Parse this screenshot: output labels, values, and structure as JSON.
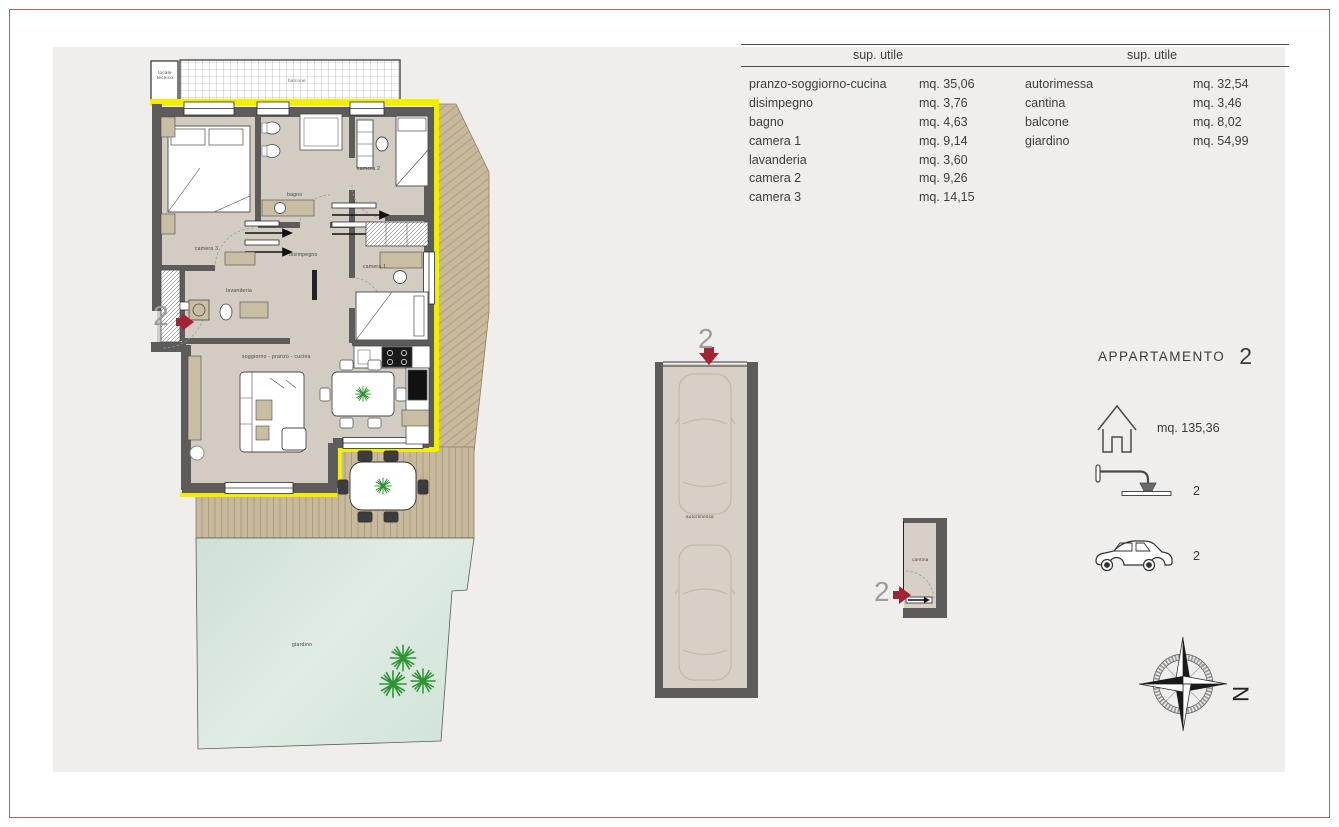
{
  "page": {
    "frame_color": "#b2605c",
    "panel_bg": "#efeeec"
  },
  "surface_table": {
    "header_left": "sup. utile",
    "header_right": "sup. utile",
    "left": [
      {
        "label": "pranzo-soggiorno-cucina",
        "value": "mq. 35,06"
      },
      {
        "label": "disimpegno",
        "value": "mq. 3,76"
      },
      {
        "label": "bagno",
        "value": "mq. 4,63"
      },
      {
        "label": "camera 1",
        "value": "mq. 9,14"
      },
      {
        "label": "lavanderia",
        "value": "mq. 3,60"
      },
      {
        "label": "camera 2",
        "value": "mq. 9,26"
      },
      {
        "label": "camera 3",
        "value": "mq. 14,15"
      }
    ],
    "right": [
      {
        "label": "autorimessa",
        "value": "mq. 32,54"
      },
      {
        "label": "cantina",
        "value": "mq. 3,46"
      },
      {
        "label": "balcone",
        "value": "mq. 8,02"
      },
      {
        "label": "giardino",
        "value": "mq. 54,99"
      }
    ]
  },
  "apartment_panel": {
    "title": "APPARTAMENTO",
    "number": "2",
    "total_area": "mq. 135,36",
    "bathrooms_count": "2",
    "cars_count": "2"
  },
  "plan_labels": {
    "balcone": "balcone",
    "locale_tecnico": "locale tecnico",
    "camera3": "camera 3",
    "bagno": "bagno",
    "camera2": "camera 2",
    "disimpegno": "disimpegno",
    "lavanderia": "lavanderia",
    "camera1": "camera 1",
    "soggiorno": "soggiorno - pranzo - cucina",
    "giardino": "giardino",
    "autorimessa": "autorimessa",
    "cantina": "cantina"
  },
  "markers": {
    "apartment": "2",
    "garage": "2",
    "cantina": "2"
  },
  "compass": {
    "north_label": "N"
  },
  "icons": {
    "house": "house-icon",
    "shower": "shower-icon",
    "car": "car-icon",
    "compass": "compass-rose-icon"
  },
  "colors": {
    "wall_grey": "#5d5c5a",
    "floor_beige": "#d3ccc3",
    "insulation_yellow": "#f2ee00",
    "deck_tan": "#c8b99d",
    "garden_green": "#d8e8de",
    "plant_green": "#2e9433",
    "marker_red": "#a02433"
  }
}
